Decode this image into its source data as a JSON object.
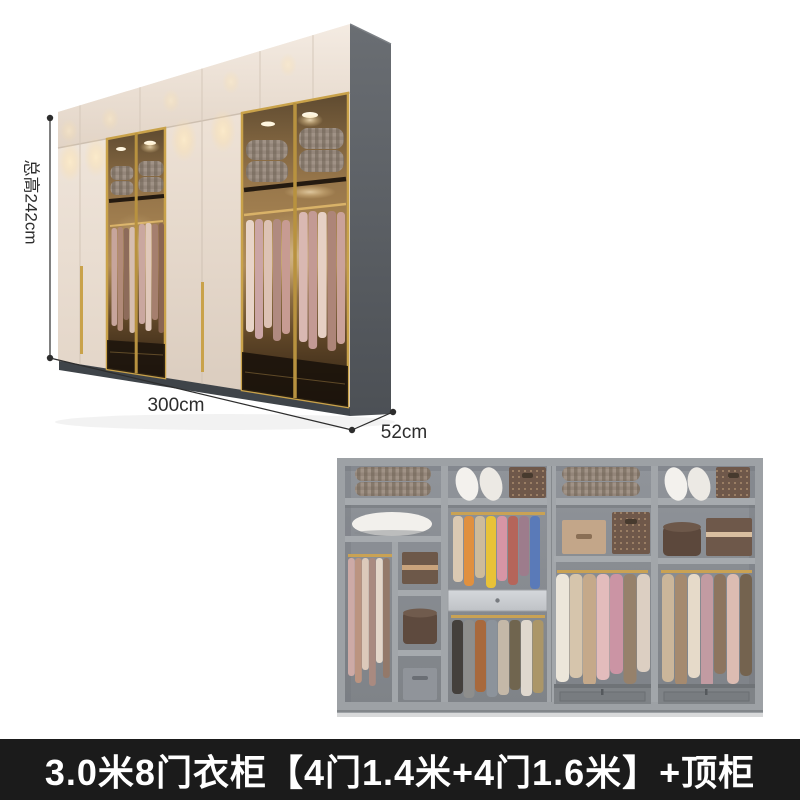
{
  "annotations": {
    "total_height": "总高242cm",
    "width": "300cm",
    "depth": "52cm"
  },
  "banner": {
    "title": "3.0米8门衣柜【4门1.4米+4门1.6米】+顶柜"
  },
  "colors": {
    "page_background": "#ffffff",
    "banner_background": "#1b1b1b",
    "banner_text": "#ffffff",
    "cabinet_cream": "#ece1d6",
    "gold_trim": "#c9a24a",
    "side_panel_gray": "#565a5f",
    "interior_frame_gray": "#9da1a5",
    "dimension_line": "#2d2d2d"
  }
}
